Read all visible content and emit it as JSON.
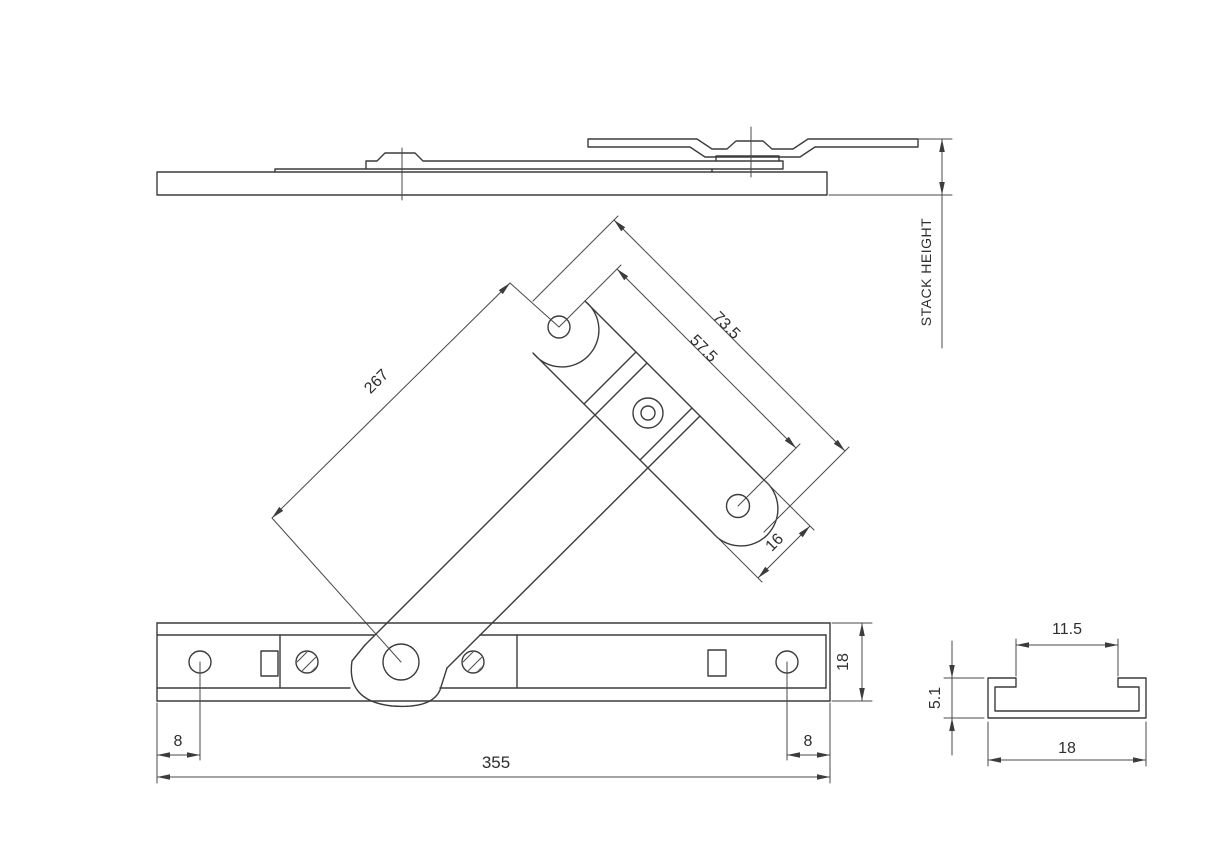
{
  "drawing": {
    "labels": {
      "stack_height": "STACK HEIGHT"
    },
    "dimensions": {
      "arm_length": "267",
      "plate_overall_length": "73.5",
      "plate_hole_centres": "57.5",
      "plate_width": "16",
      "hole_offset_left": "8",
      "track_length": "355",
      "hole_offset_right": "8",
      "track_width": "18",
      "profile_slot_width": "11.5",
      "profile_height": "5.1",
      "profile_width": "18"
    }
  }
}
